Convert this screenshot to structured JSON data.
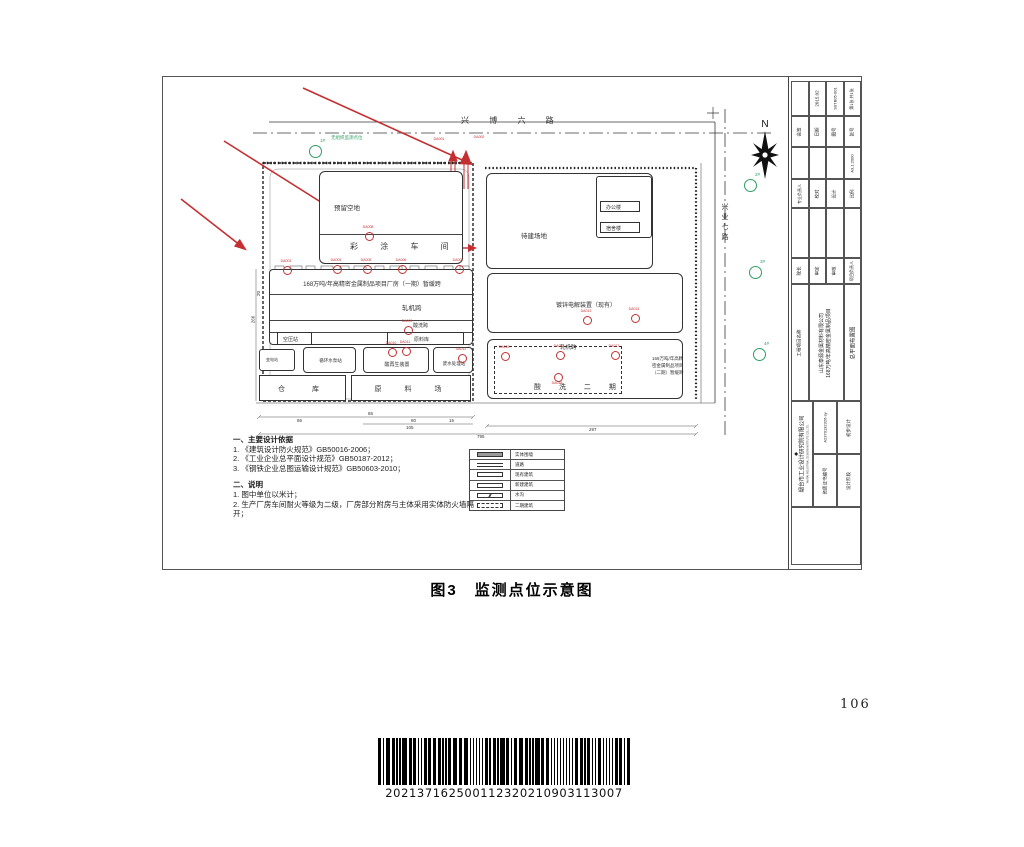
{
  "page": {
    "caption": "图3　监测点位示意图",
    "page_number": "106",
    "barcode_digits": "202137162500112320210903113007"
  },
  "drawing": {
    "roads": {
      "north_road": "兴 博 六 路",
      "east_road": "兴业七路",
      "compass": "N"
    },
    "site": {
      "unorganized_note": "无组织监测点位"
    },
    "buildings": {
      "reserved": "预留空地",
      "coating": "彩 涂 车 间",
      "plant1": "168万吨/年高精密金属制品项目厂房（一期）暂缓跨",
      "mill": "轧机跨",
      "pickling": "酸洗跨",
      "raw_store": "原料库",
      "air_comp": "空压站",
      "substation": "变电站",
      "pump": "循环水泵站",
      "acid_regen": "酸再生装置",
      "wastewater": "废水处理站",
      "warehouse": "仓　库",
      "raw_yard": "原　料　场",
      "to_build": "待建场地",
      "office": "办公楼",
      "dorm": "宿舍楼",
      "galvanize": "镀锌电解装置（现有）",
      "mill2": "轧机跨",
      "pickling2": "酸 洗 二 期",
      "phase2_1": "168万吨/年高精",
      "phase2_2": "密金属制品项目",
      "phase2_3": "（二期）暂缓跨"
    },
    "notes": {
      "h1": "一、主要设计依据",
      "items1": [
        "1. 《建筑设计防火规范》GB50016-2006；",
        "2. 《工业企业总平面设计规范》GB50187-2012；",
        "3. 《钢铁企业总图运输设计规范》GB50603-2010；"
      ],
      "h2": "二、说明",
      "items2": [
        "1. 图中单位以米计；",
        "2. 生产厂房车间耐火等级为二级，厂房部分附房与主体采用实体防火墙隔开；"
      ]
    },
    "legend": {
      "rows": [
        {
          "label": "实体围墙"
        },
        {
          "label": "道路"
        },
        {
          "label": "现有建筑"
        },
        {
          "label": "新建建筑"
        },
        {
          "label": "水沟"
        },
        {
          "label": "二期建筑"
        }
      ]
    },
    "markers": {
      "red": [
        {
          "x": 276,
          "y": 70,
          "label": "DA001",
          "circle": false
        },
        {
          "x": 316,
          "y": 68,
          "label": "DA002",
          "circle": false
        },
        {
          "x": 123,
          "y": 192,
          "label": "DA003"
        },
        {
          "x": 173,
          "y": 191,
          "label": "DA004"
        },
        {
          "x": 203,
          "y": 191,
          "label": "DA005"
        },
        {
          "x": 238,
          "y": 191,
          "label": "DA006"
        },
        {
          "x": 295,
          "y": 191,
          "label": "DA007"
        },
        {
          "x": 205,
          "y": 158,
          "label": "DA008"
        },
        {
          "x": 244,
          "y": 252,
          "label": "DA009"
        },
        {
          "x": 228,
          "y": 274,
          "label": "DA010"
        },
        {
          "x": 242,
          "y": 273,
          "label": "DA011"
        },
        {
          "x": 298,
          "y": 280,
          "label": "DA012"
        },
        {
          "x": 423,
          "y": 242,
          "label": "DA013"
        },
        {
          "x": 471,
          "y": 240,
          "label": "DA014"
        },
        {
          "x": 341,
          "y": 278,
          "label": "DA015"
        },
        {
          "x": 396,
          "y": 277,
          "label": "DA016"
        },
        {
          "x": 451,
          "y": 277,
          "label": "DA017"
        },
        {
          "x": 394,
          "y": 299,
          "label": "DA018",
          "below": true
        }
      ],
      "green": [
        {
          "x": 151,
          "y": 73,
          "label": "1#"
        },
        {
          "x": 586,
          "y": 107,
          "label": "2#"
        },
        {
          "x": 591,
          "y": 194,
          "label": "3#"
        },
        {
          "x": 595,
          "y": 276,
          "label": "4#"
        }
      ]
    },
    "dims": [
      {
        "x": 134,
        "y": 341,
        "t": "86"
      },
      {
        "x": 205,
        "y": 334,
        "t": "85"
      },
      {
        "x": 248,
        "y": 341,
        "t": "80"
      },
      {
        "x": 286,
        "y": 341,
        "t": "15"
      },
      {
        "x": 243,
        "y": 348,
        "t": "105"
      },
      {
        "x": 314,
        "y": 357,
        "t": "795"
      },
      {
        "x": 426,
        "y": 350,
        "t": "297"
      },
      {
        "x": 86,
        "y": 240,
        "t": "266",
        "rot": true
      },
      {
        "x": 93,
        "y": 214,
        "t": "20",
        "rot": true
      }
    ],
    "titleblock": {
      "rows": [
        {
          "cells": [
            "",
            "2015.02",
            "S0TB05-001",
            "第1张 共1张"
          ]
        },
        {
          "cells": [
            "会签",
            "日期",
            "图号",
            "张号"
          ]
        },
        {
          "cells": [
            "",
            "",
            "",
            "A3,1:2000"
          ]
        },
        {
          "cells": [
            "专业负责人",
            "校对",
            "设计",
            "比例"
          ]
        },
        {
          "cells": [
            "",
            "",
            "",
            ""
          ]
        },
        {
          "cells": [
            "院长",
            "审定",
            "审核",
            "项目负责人"
          ]
        }
      ],
      "project_label": "工程项目名称",
      "project_name1": "山东泰源金属材料有限公司",
      "project_name2": "168万吨/年高精密金属制品项目",
      "drawing_title": "总平面布置图",
      "company": "烟台市工业设计研究院有限公司",
      "company_en": "YANTAI INDUSTRIAL DESIGN INSTITUTE CO.,LTD.",
      "company_logo": "◆",
      "cert_label": "资质证书编号",
      "cert_no": "A2370132326-sy",
      "stage_label": "设计阶段",
      "stage_value": "初步设计"
    }
  }
}
